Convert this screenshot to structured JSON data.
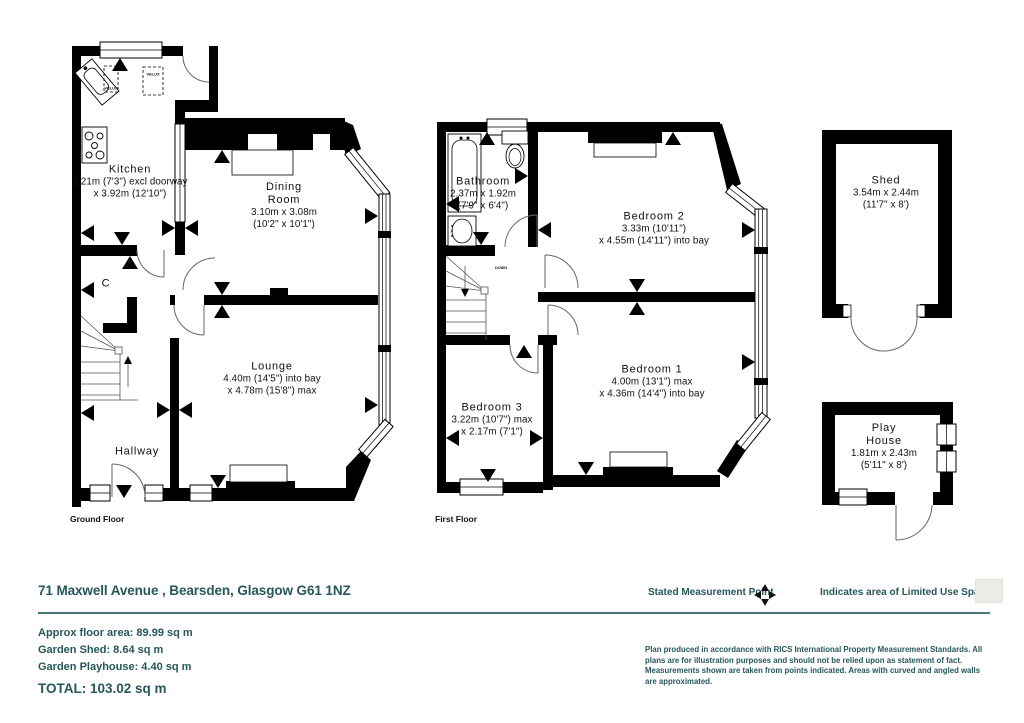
{
  "plan": {
    "ground_floor": {
      "caption": "Ground Floor",
      "rooms": {
        "kitchen": {
          "name": "Kitchen",
          "dims": "2.21m (7'3\") excl doorway\nx 3.92m (12'10\")"
        },
        "dining": {
          "name": "Dining\nRoom",
          "dims": "3.10m x 3.08m\n(10'2\" x 10'1\")"
        },
        "lounge": {
          "name": "Lounge",
          "dims": "4.40m (14'5\") into bay\nx 4.78m (15'8\") max"
        },
        "hallway": {
          "name": "Hallway"
        },
        "cupboard": {
          "name": "C"
        }
      },
      "labels": {
        "velux": "VELUX"
      }
    },
    "first_floor": {
      "caption": "First Floor",
      "rooms": {
        "bathroom": {
          "name": "Bathroom",
          "dims": "2.37m x 1.92m\n(7'9\" x 6'4\")"
        },
        "bedroom2": {
          "name": "Bedroom 2",
          "dims": "3.33m (10'11\")\nx 4.55m (14'11\") into bay"
        },
        "bedroom1": {
          "name": "Bedroom 1",
          "dims": "4.00m (13'1\") max\nx 4.36m (14'4\") into bay"
        },
        "bedroom3": {
          "name": "Bedroom 3",
          "dims": "3.22m (10'7\") max\nx 2.17m (7'1\")"
        }
      },
      "labels": {
        "down": "DOWN"
      }
    },
    "outbuildings": {
      "shed": {
        "name": "Shed",
        "dims": "3.54m x 2.44m\n(11'7\" x 8')"
      },
      "playhouse": {
        "name": "Play\nHouse",
        "dims": "1.81m x 2.43m\n(5'11\" x 8')"
      }
    }
  },
  "footer": {
    "address": "71 Maxwell Avenue , Bearsden, Glasgow  G61 1NZ",
    "areas": [
      "Approx floor area: 89.99 sq m",
      "Garden Shed: 8.64 sq m",
      "Garden Playhouse: 4.40 sq m"
    ],
    "total": "TOTAL: 103.02 sq m",
    "legend": {
      "measurement_point": "Stated Measurement Point",
      "limited_use": "Indicates area of  Limited Use Space"
    },
    "disclaimer": "Plan produced  in accordance with RICS International Property  Measurement Standards.  All plans are for illustration purposes and should not be relied upon as statement of fact.  Measurements shown are taken from points indicated. Areas with curved and angled walls are approximated.",
    "colors": {
      "accent": "#265759",
      "limited_use_swatch": "#ebece6",
      "wall": "#000000"
    }
  }
}
